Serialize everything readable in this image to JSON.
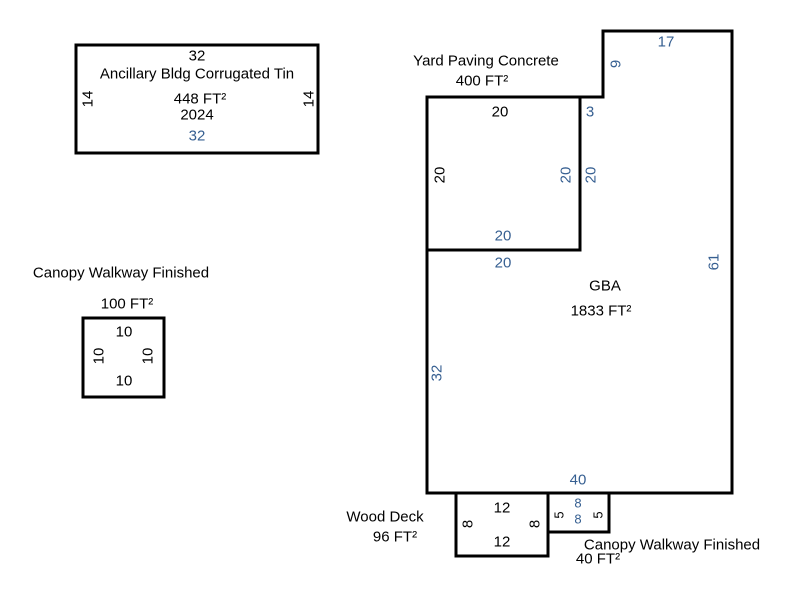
{
  "colors": {
    "dimension_blue": "#365F91",
    "ink": "#000000",
    "background": "#FFFFFF"
  },
  "areas": {
    "ancillary": {
      "title": "Ancillary Bldg Corrugated Tin",
      "area": "448 FT²",
      "year": "2024",
      "dims": {
        "top": "32",
        "bottom": "32",
        "left": "14",
        "right": "14"
      }
    },
    "canopy_walkway_left": {
      "title": "Canopy Walkway Finished",
      "area": "100 FT²",
      "dims": {
        "top": "10",
        "bottom": "10",
        "left": "10",
        "right": "10"
      }
    },
    "yard_paving": {
      "title": "Yard Paving Concrete",
      "area": "400 FT²",
      "dims": {
        "top": "20",
        "left": "20",
        "right_inner": "20",
        "right_outer": "20",
        "bottom_inner": "20",
        "bottom_outer": "20"
      }
    },
    "gba": {
      "title": "GBA",
      "area": "1833 FT²",
      "dims": {
        "top": "17",
        "upper_left": "9",
        "step": "3",
        "left": "32",
        "right": "61",
        "bottom": "40"
      }
    },
    "wood_deck": {
      "title": "Wood Deck",
      "area": "96 FT²",
      "dims": {
        "top": "12",
        "bottom": "12",
        "left": "8",
        "right": "8"
      }
    },
    "canopy_walkway_right": {
      "title": "Canopy Walkway Finished",
      "area": "40 FT²",
      "dims": {
        "top": "8",
        "bottom": "8",
        "left": "5",
        "right": "5"
      }
    }
  }
}
